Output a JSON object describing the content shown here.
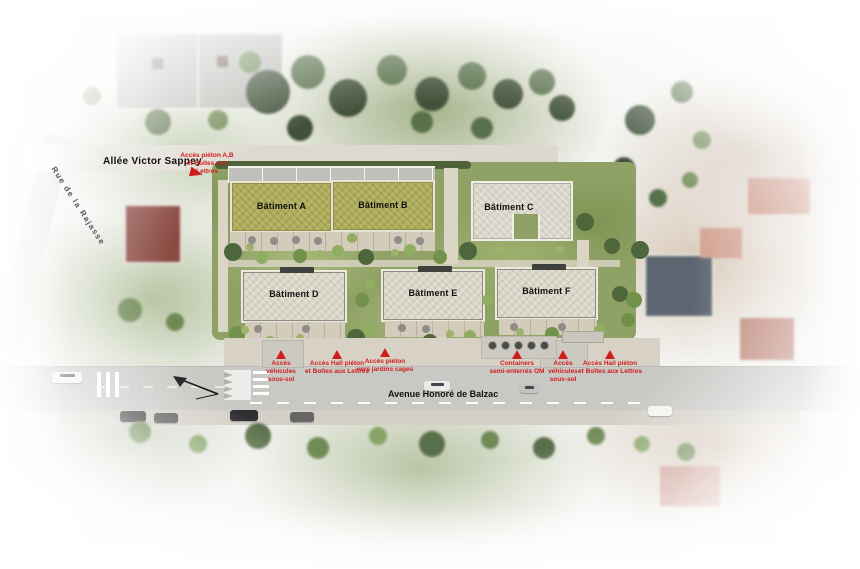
{
  "plan": {
    "streets": {
      "allee_victor_sappey": "Allée Victor Sappey",
      "rue_de_la_rajasse": "Rue de la Rajasse",
      "avenue_honore_de_balzac": "Avenue Honoré de Balzac"
    },
    "buildings": [
      {
        "id": "A",
        "label": "Bâtiment A"
      },
      {
        "id": "B",
        "label": "Bâtiment B"
      },
      {
        "id": "C",
        "label": "Bâtiment C"
      },
      {
        "id": "D",
        "label": "Bâtiment D"
      },
      {
        "id": "E",
        "label": "Bâtiment E"
      },
      {
        "id": "F",
        "label": "Bâtiment F"
      }
    ],
    "annotations": {
      "top": "Accès piéton A,B\net Boîtes aux Lettres",
      "bottom": [
        "Accès\nvéhicules\nsous-sol",
        "Accès Hall piéton\net Boîtes aux Lettres",
        "Accès piéton\nvers jardins cages",
        "Containers\nsemi-enterrés OM",
        "Accès\nvéhicules\nsous-sol",
        "Accès Hall piéton\net Boîtes aux Lettres"
      ]
    },
    "colors": {
      "annotation_red": "#cf1d1d",
      "green_roof": "#aeab57",
      "light_roof": "#d9d5cb",
      "road_gray": "#c8c8c5"
    }
  }
}
